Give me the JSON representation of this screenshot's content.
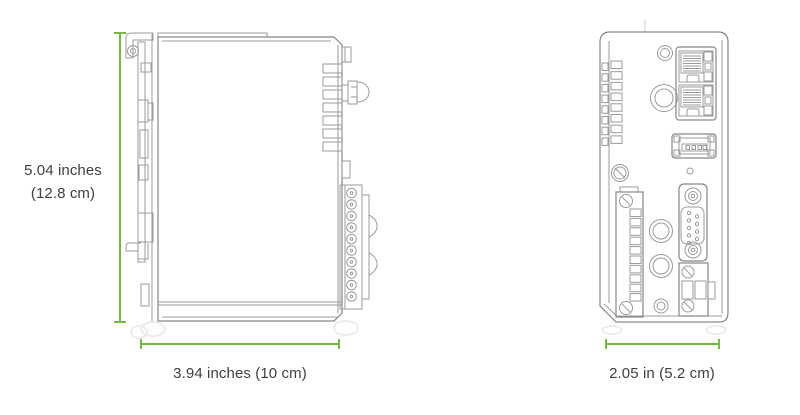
{
  "page": {
    "background": "#ffffff",
    "description_visible_text_only": true
  },
  "colors": {
    "dimension_line_green": "#74b943",
    "drawing_line_gray": "#9b9b9b",
    "label_text_gray": "#3f4040"
  },
  "dimensions": {
    "height": {
      "line1": "5.04 inches",
      "line2": "(12.8 cm)"
    },
    "width": {
      "label": "3.94 inches (10 cm)"
    },
    "depth": {
      "label": "2.05 in (5.2 cm)"
    }
  }
}
